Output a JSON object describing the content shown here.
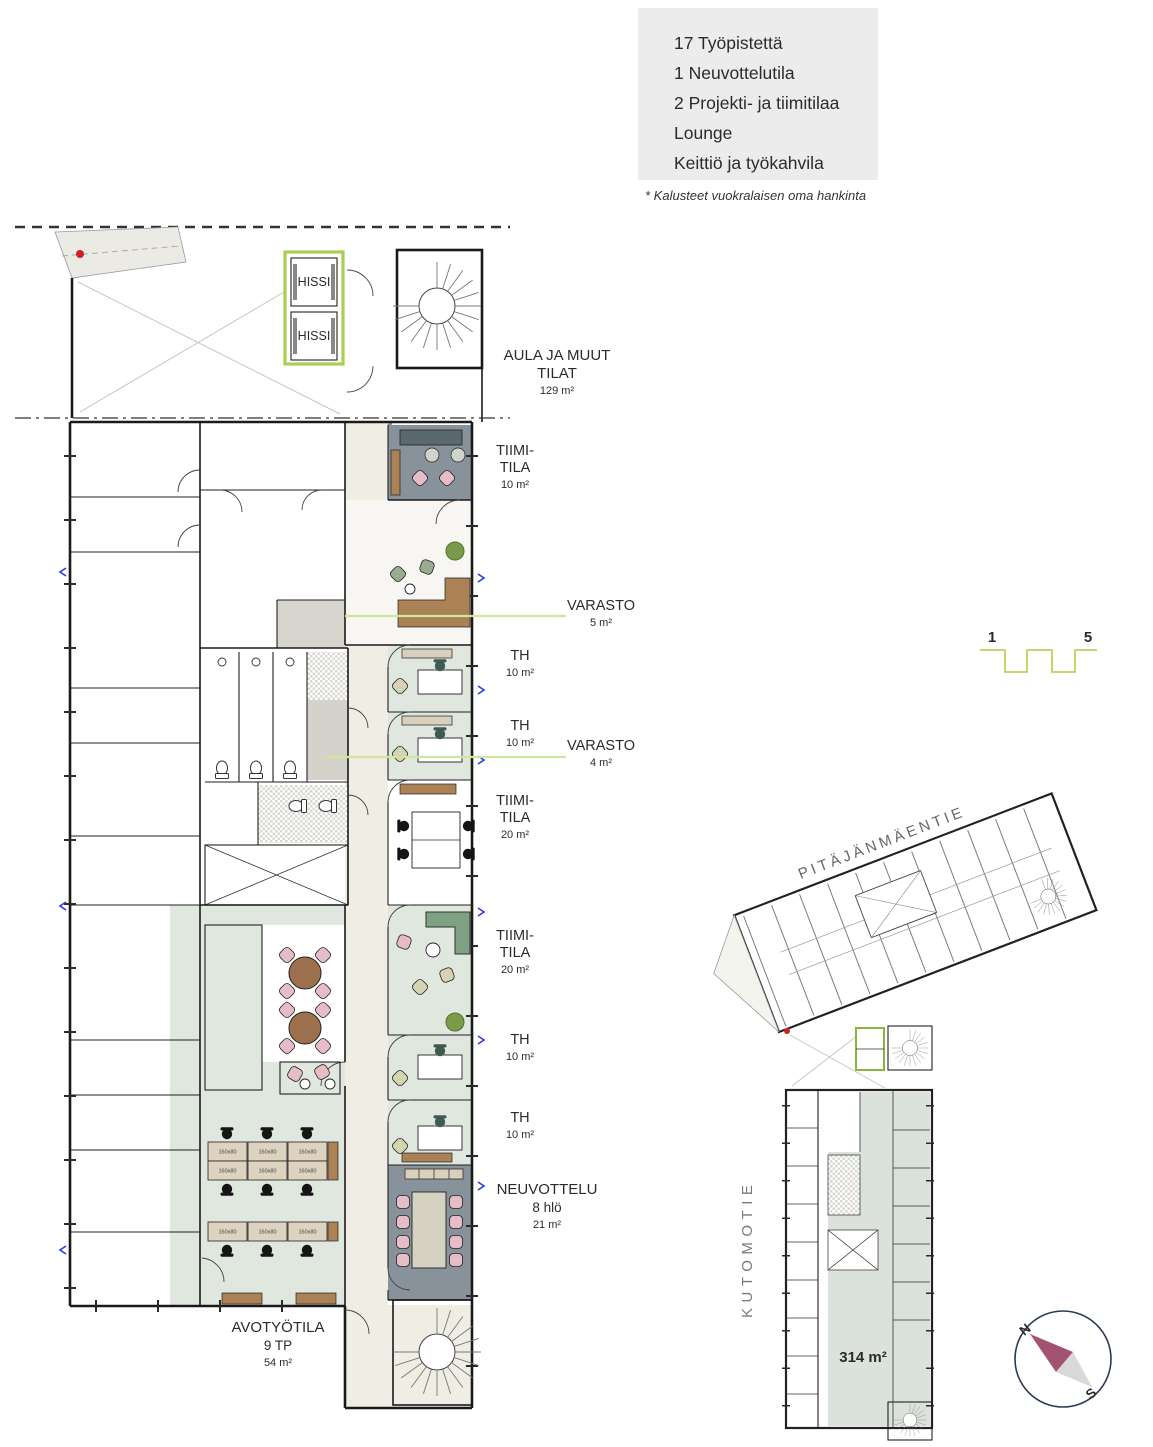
{
  "legend": {
    "lines": [
      "17 Työpistettä",
      "1 Neuvottelutila",
      "2 Projekti- ja tiimitilaa",
      "Lounge",
      "Keittiö ja työkahvila"
    ],
    "note": "* Kalusteet vuokralaisen oma hankinta"
  },
  "plan": {
    "elevator_label": "HISSI",
    "aula": {
      "l1": "AULA JA MUUT",
      "l2": "TILAT",
      "area": "129 m²"
    },
    "tiimitila": [
      {
        "l1": "TIIMI-",
        "l2": "TILA",
        "area": "10 m²"
      },
      {
        "l1": "TIIMI-",
        "l2": "TILA",
        "area": "20 m²"
      },
      {
        "l1": "TIIMI-",
        "l2": "TILA",
        "area": "20 m²"
      }
    ],
    "varasto": [
      {
        "name": "VARASTO",
        "area": "5 m²"
      },
      {
        "name": "VARASTO",
        "area": "4 m²"
      }
    ],
    "th": [
      {
        "name": "TH",
        "area": "10 m²"
      },
      {
        "name": "TH",
        "area": "10 m²"
      },
      {
        "name": "TH",
        "area": "10 m²"
      },
      {
        "name": "TH",
        "area": "10 m²"
      }
    ],
    "neuvottelu": {
      "name": "NEUVOTTELU",
      "capacity": "8 hlö",
      "area": "21 m²"
    },
    "avotyotila": {
      "name": "AVOTYÖTILA",
      "workstations": "9 TP",
      "area": "54 m²"
    },
    "desk_size": "160x80"
  },
  "site": {
    "street_top": "PITÄJÄNMÄENTIE",
    "street_left": "KUTOMOTIE",
    "unit_area": "314 m²",
    "scale_bar": {
      "from": "1",
      "to": "5"
    },
    "compass": {
      "n": "N",
      "s": "S"
    }
  },
  "colors": {
    "accent_green": "#a8cf52",
    "floor_sage": "#dfe7df",
    "floor_dark": "#87929a",
    "site_highlight": "#dbe2db",
    "wood": "#ab8156",
    "chair_pink": "#e6bcc6",
    "compass_needle": "#a35273"
  }
}
